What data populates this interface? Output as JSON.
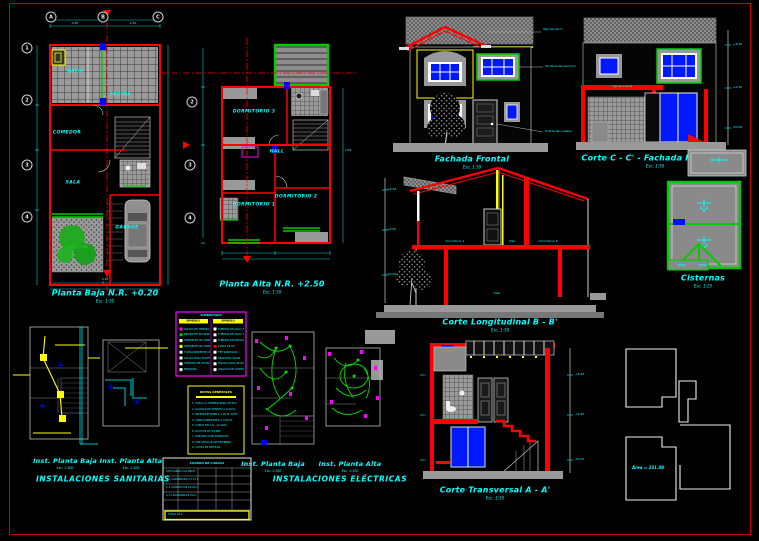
{
  "sheet": {
    "bg": "#000000",
    "frame_color": "#cc0000"
  },
  "planta_baja": {
    "title": "Planta Baja N.R. +0.20",
    "scale": "Esc. 1:50",
    "grid_cols": [
      "A",
      "B",
      "C"
    ],
    "grid_rows": [
      "1",
      "2",
      "3",
      "4"
    ],
    "rooms": {
      "patio": "PATIO",
      "cocina": "COCINA",
      "comedor": "COMEDOR",
      "sala": "SALA",
      "jardin": "JARDIN",
      "garage": "GARAGE"
    },
    "dims": [
      "2.85",
      "2.50",
      "5.35"
    ]
  },
  "planta_alta": {
    "title": "Planta Alta N.R. +2.50",
    "scale": "Esc. 1:50",
    "grid_rows": [
      "2",
      "3",
      "4"
    ],
    "rooms": {
      "dormitorio3": "DORMITORIO 3",
      "hall": "HALL",
      "dormitorio1": "DORMITORIO 1",
      "dormitorio2": "DORMITORIO 2"
    },
    "dims": [
      "7.60"
    ]
  },
  "fachada_frontal": {
    "title": "Fachada Frontal",
    "scale": "Esc. 1:50",
    "annotations": [
      "Teja de barro",
      "Ventana de aluminio",
      "Puerta de madera"
    ]
  },
  "corte_c": {
    "title": "Corte C - C' - Fachada Posterior",
    "scale": "Esc. 1:50",
    "beam_label": "Viga de amarre",
    "levels": [
      "+5.46",
      "+2.50",
      "±0.00"
    ]
  },
  "cisternas": {
    "title": "Cisternas",
    "scale": "Esc. 1:25"
  },
  "corte_longitudinal": {
    "title": "Corte Longitudinal B - B'",
    "scale": "Esc. 1:50",
    "labels": {
      "dormitorio1": "Dormitorio 1",
      "hall": "Hall",
      "dormitorio3": "Dormitorio 3",
      "sala": "Sala"
    },
    "levels": [
      "+5.46",
      "+2.50",
      "±0.00"
    ]
  },
  "corte_transversal": {
    "title": "Corte Transversal A - A'",
    "scale": "Esc. 1:50",
    "levels": [
      "+5.46",
      "+2.50",
      "±0.00"
    ]
  },
  "inst_sanitarias": {
    "left_title": "Inst. Planta Baja",
    "left_scale": "Esc. 1:100",
    "right_title": "Inst. Planta Alta",
    "right_scale": "Esc. 1:100",
    "title": "INSTALACIONES SANITARIAS"
  },
  "inst_electricas": {
    "left_title": "Inst. Planta Baja",
    "left_scale": "Esc. 1:100",
    "right_title": "Inst. Planta Alta",
    "right_scale": "Esc. 1:100",
    "title": "INSTALACIONES ELÉCTRICAS"
  },
  "simbologia": {
    "title": "SIMBOLOGIA",
    "left_header": "SIMBOLO",
    "right_header": "SIMBOLO",
    "left_rows": [
      "SALIDA DE CENTRO",
      "BRAQUETE EN MURO",
      "INTERRUPTOR SIMPLE",
      "INTERRUPTOR CONMUTADO",
      "TOMACORRIENTE DOBLE",
      "SALIDA PARA TELEFONO",
      "TABLERO DE DISTRIBUCION",
      "MEDIDOR"
    ],
    "right_rows": [
      "TUBERIA DE AGUA FRIA",
      "TUBERIA DE AGUA CALIENTE",
      "TUBERIA DE DESAGUE",
      "CODO DE 90",
      "TEE SANITARIA",
      "REGISTRO 40x60",
      "BAJADA AGUA PLUVIAL",
      "VALVULA DE CONTROL"
    ]
  },
  "notas": {
    "title": "NOTAS GENERALES",
    "lines": [
      "1. TODA LA TUBERIA SERA DE PVC.",
      "2. SALIDAS DE CENTRO A 2.40 M.",
      "3. INTERRUPTORES A 1.20 M. N.P.T.",
      "4. TOMACORRIENTES A 0.40 M.",
      "5. CABLE TW CAL. 12 AWG.",
      "6. DUCTOS DE 13 MM.",
      "7. TABLERO CON TERMICOS.",
      "8. VER DETALLE DE CISTERNA.",
      "9. COTAS EN METROS."
    ]
  },
  "cuadro": {
    "title": "CUADRO DE CARGAS",
    "header": "CTO  CARGA  CAL  PROT",
    "rows": [
      "C-1  ALUMBRADO  12  15 A",
      "C-2  CONTACTOS  12  20 A",
      "C-3  LAVADORA  10  30 A"
    ],
    "total": "TOTAL  65 A"
  },
  "key_plan": {
    "area_label": "Área = 231.08"
  }
}
